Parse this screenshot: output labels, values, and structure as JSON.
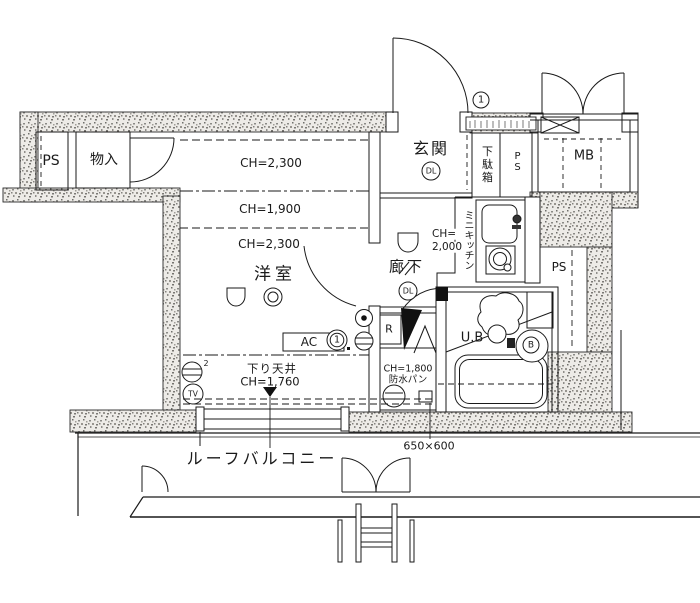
{
  "colors": {
    "line": "#1a1a1a",
    "wall_speckle": "#8a8a86",
    "bg": "#ffffff"
  },
  "areas": {
    "storage": {
      "ps": "PS",
      "closet": "物入"
    },
    "room": {
      "name": "洋室",
      "ch_upper": "CH=2,300",
      "ch_mid": "CH=1,900",
      "ch_lower": "CH=2,300",
      "dropped_ceiling": "下り天井",
      "dropped_ceiling_ch": "CH=1,760",
      "ac_label": "AC",
      "ac_note": "1",
      "outlet_sup": "2",
      "tv_label": "TV"
    },
    "entrance": {
      "name": "玄関",
      "downlight": "DL",
      "shoe_cabinet": "下駄箱",
      "pipe_space": "PS",
      "door_note": "1"
    },
    "hallway": {
      "name": "廊下",
      "downlight": "DL",
      "ch_line1": "CH=",
      "ch_line2": "2,000"
    },
    "kitchen": {
      "name": "ミニキッチン"
    },
    "bath": {
      "name": "U.B",
      "note": "B"
    },
    "laundry": {
      "ch": "CH=1,800",
      "pan": "防水パン",
      "pan_size": "650×600",
      "fridge_note": "R"
    },
    "meter_box": {
      "name": "MB"
    },
    "shaft_right": {
      "name": "PS"
    },
    "balcony": {
      "name": "ルーフバルコニー"
    }
  }
}
